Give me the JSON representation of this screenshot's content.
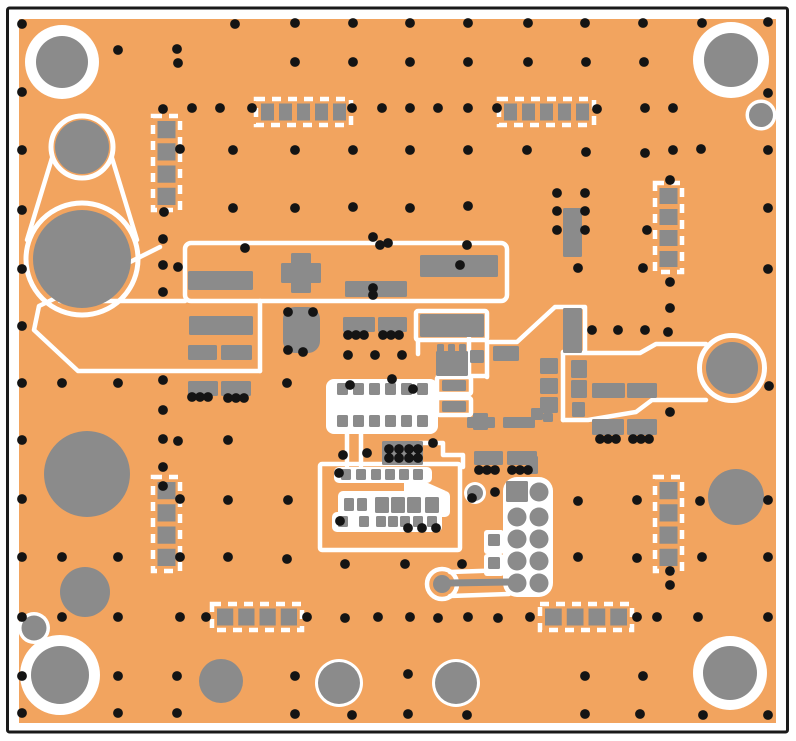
{
  "figure": {
    "kind": "pcb-layout-top-view",
    "width": 796,
    "height": 741
  },
  "colors": {
    "page": "#FFFFFF",
    "frame": "#1A1A1A",
    "board": "#F2A45F",
    "copper": "#8B8B8B",
    "silk": "#FFFFFF",
    "via": "#141414"
  },
  "frame": {
    "x": 7.5,
    "y": 8,
    "w": 780,
    "h": 724,
    "stroke": 3
  },
  "board": {
    "x": 19,
    "y": 19,
    "w": 757,
    "h": 704
  },
  "silk_strokes": [
    {
      "t": "ci",
      "c": [
        82,
        147,
        31
      ],
      "sw": 5
    },
    {
      "t": "ci",
      "c": [
        82,
        259,
        56
      ],
      "sw": 5
    },
    {
      "t": "ln",
      "c": [
        52,
        158,
        27,
        240
      ]
    },
    {
      "t": "ln",
      "c": [
        112,
        158,
        137,
        240
      ]
    },
    {
      "t": "pl",
      "p": "160,247 100,277 39,306 34,330 78,371 260,371"
    },
    {
      "t": "ln",
      "c": [
        60,
        301,
        185,
        301
      ]
    },
    {
      "t": "rc",
      "c": [
        185,
        243,
        322,
        58
      ],
      "rx": 6
    },
    {
      "t": "ln",
      "c": [
        260,
        301,
        260,
        371
      ]
    },
    {
      "t": "rc",
      "c": [
        416,
        311,
        71,
        29
      ]
    },
    {
      "t": "ln",
      "c": [
        469,
        338,
        469,
        377
      ]
    },
    {
      "t": "ln",
      "c": [
        487,
        342,
        487,
        377
      ]
    },
    {
      "t": "ln",
      "c": [
        438,
        376,
        487,
        376
      ]
    },
    {
      "t": "ln",
      "c": [
        418,
        340,
        418,
        354
      ]
    },
    {
      "t": "pl",
      "p": "487,342 517,342 555,307 585,307 585,352"
    },
    {
      "t": "pl",
      "p": "563,353 640,353 656,344 706,344"
    },
    {
      "t": "ln",
      "c": [
        563,
        420,
        563,
        352
      ]
    },
    {
      "t": "pl",
      "p": "706,400 652,400 636,412 588,420 563,420"
    },
    {
      "t": "ci",
      "c": [
        732,
        368,
        32.5
      ],
      "sw": 5
    },
    {
      "t": "ci",
      "c": [
        442,
        584,
        15
      ],
      "sw": 4.5
    },
    {
      "t": "ln",
      "c": [
        450,
        572,
        509,
        570
      ]
    },
    {
      "t": "ln",
      "c": [
        450,
        596,
        509,
        594
      ]
    },
    {
      "t": "rc",
      "c": [
        320,
        464,
        140,
        86
      ]
    },
    {
      "t": "ln",
      "c": [
        347,
        432,
        347,
        466
      ]
    },
    {
      "t": "ln",
      "c": [
        361,
        432,
        361,
        466
      ]
    },
    {
      "t": "pl",
      "p": "420,443 443,443 443,455 463,455 463,467"
    },
    {
      "t": "rc",
      "c": [
        437,
        377,
        34,
        17
      ]
    },
    {
      "t": "rc",
      "c": [
        437,
        398,
        34,
        17
      ]
    }
  ],
  "silk_blobs": [
    {
      "t": "rc",
      "c": [
        326,
        379,
        112,
        55
      ],
      "rx": 8
    },
    {
      "t": "rc",
      "c": [
        334,
        467,
        98,
        16
      ],
      "rx": 5
    },
    {
      "t": "rc",
      "c": [
        338,
        491,
        112,
        26
      ],
      "rx": 5
    },
    {
      "t": "rc",
      "c": [
        332,
        512,
        110,
        20
      ],
      "rx": 5
    },
    {
      "t": "pg",
      "p": "404,483 428,483 446,491 404,491"
    },
    {
      "t": "rc",
      "c": [
        503,
        477,
        50,
        120
      ],
      "rx": 14
    },
    {
      "t": "rc",
      "c": [
        484,
        530,
        20,
        24
      ],
      "rx": 3
    },
    {
      "t": "rc",
      "c": [
        484,
        554,
        20,
        22
      ],
      "rx": 3
    }
  ],
  "footprints": [
    {
      "x": 153,
      "y": 116,
      "w": 27,
      "h": 94,
      "n": 4,
      "dir": "v"
    },
    {
      "x": 153,
      "y": 477,
      "w": 27,
      "h": 94,
      "n": 4,
      "dir": "v"
    },
    {
      "x": 655,
      "y": 183,
      "w": 27,
      "h": 89,
      "n": 4,
      "dir": "v"
    },
    {
      "x": 655,
      "y": 477,
      "w": 27,
      "h": 94,
      "n": 4,
      "dir": "v"
    },
    {
      "x": 256,
      "y": 99,
      "w": 95,
      "h": 26,
      "n": 5,
      "dir": "h"
    },
    {
      "x": 499,
      "y": 99,
      "w": 95,
      "h": 26,
      "n": 5,
      "dir": "h"
    },
    {
      "x": 212,
      "y": 604,
      "w": 90,
      "h": 26,
      "n": 4,
      "dir": "h"
    },
    {
      "x": 540,
      "y": 604,
      "w": 92,
      "h": 26,
      "n": 4,
      "dir": "h"
    }
  ],
  "pads": [
    [
      188,
      271,
      65,
      19
    ],
    [
      420,
      255,
      78,
      22
    ],
    [
      345,
      281,
      62,
      16
    ],
    [
      281,
      263,
      40,
      20
    ],
    [
      291,
      253,
      20,
      40
    ],
    [
      189,
      316,
      64,
      19
    ],
    [
      188,
      345,
      29,
      15
    ],
    [
      221,
      345,
      31,
      15
    ],
    [
      188,
      381,
      30,
      15
    ],
    [
      221,
      381,
      30,
      15
    ],
    [
      343,
      317,
      32,
      15
    ],
    [
      378,
      317,
      29,
      15
    ],
    [
      283,
      307,
      37,
      46,
      12
    ],
    [
      420,
      314,
      64,
      23
    ],
    [
      436,
      351,
      32,
      25
    ],
    [
      437,
      344,
      7,
      8
    ],
    [
      448,
      344,
      7,
      8
    ],
    [
      459,
      344,
      7,
      8
    ],
    [
      470,
      350,
      14,
      13
    ],
    [
      493,
      346,
      26,
      15
    ],
    [
      563,
      308,
      19,
      45
    ],
    [
      563,
      208,
      19,
      49
    ],
    [
      540,
      358,
      18,
      16
    ],
    [
      540,
      378,
      18,
      16
    ],
    [
      540,
      397,
      18,
      16
    ],
    [
      571,
      360,
      16,
      18
    ],
    [
      571,
      380,
      16,
      18
    ],
    [
      572,
      402,
      13,
      15
    ],
    [
      592,
      383,
      33,
      15
    ],
    [
      627,
      383,
      30,
      15
    ],
    [
      592,
      419,
      32,
      16
    ],
    [
      627,
      419,
      30,
      16
    ],
    [
      531,
      408,
      12,
      12
    ],
    [
      543,
      413,
      10,
      9
    ],
    [
      526,
      456,
      12,
      18
    ],
    [
      467,
      417,
      28,
      11
    ],
    [
      503,
      417,
      32,
      11
    ],
    [
      474,
      451,
      29,
      14
    ],
    [
      507,
      451,
      30,
      14
    ],
    [
      506,
      481,
      22,
      21
    ],
    [
      488,
      534,
      12,
      12
    ],
    [
      488,
      557,
      12,
      12
    ],
    [
      442,
      380,
      24,
      11
    ],
    [
      442,
      401,
      24,
      11
    ],
    [
      473,
      413,
      15,
      17
    ],
    [
      382,
      441,
      41,
      24
    ],
    [
      337,
      383,
      11,
      12
    ],
    [
      353,
      383,
      11,
      12
    ],
    [
      369,
      383,
      11,
      12
    ],
    [
      385,
      383,
      11,
      12
    ],
    [
      401,
      383,
      11,
      12
    ],
    [
      417,
      383,
      11,
      12
    ],
    [
      337,
      415,
      11,
      12
    ],
    [
      353,
      415,
      11,
      12
    ],
    [
      369,
      415,
      11,
      12
    ],
    [
      385,
      415,
      11,
      12
    ],
    [
      401,
      415,
      11,
      12
    ],
    [
      417,
      415,
      11,
      12
    ],
    [
      341,
      469,
      10,
      11
    ],
    [
      356,
      469,
      10,
      11
    ],
    [
      371,
      469,
      10,
      11
    ],
    [
      385,
      469,
      10,
      11
    ],
    [
      399,
      469,
      10,
      11
    ],
    [
      413,
      469,
      10,
      11
    ],
    [
      344,
      498,
      10,
      13
    ],
    [
      357,
      498,
      10,
      13
    ],
    [
      375,
      497,
      14,
      16
    ],
    [
      391,
      497,
      14,
      16
    ],
    [
      407,
      497,
      14,
      16
    ],
    [
      425,
      497,
      14,
      16
    ],
    [
      338,
      516,
      10,
      11
    ],
    [
      359,
      516,
      10,
      11
    ],
    [
      376,
      516,
      10,
      11
    ],
    [
      388,
      516,
      10,
      11
    ],
    [
      400,
      516,
      10,
      11
    ],
    [
      413,
      516,
      10,
      11
    ],
    [
      427,
      516,
      10,
      11
    ]
  ],
  "copper_trace": {
    "x1": 450,
    "y1": 583,
    "x2": 512,
    "y2": 582,
    "w": 7
  },
  "plain_circles": [
    [
      82,
      147,
      27
    ],
    [
      82,
      259,
      49
    ],
    [
      87,
      474,
      43
    ],
    [
      85,
      592,
      25
    ],
    [
      221,
      681,
      22
    ],
    [
      736,
      497,
      28
    ],
    [
      732,
      368,
      26
    ],
    [
      442,
      584,
      9
    ],
    [
      539,
      492,
      9.5
    ],
    [
      517,
      517,
      9.5
    ],
    [
      539,
      517,
      9.5
    ],
    [
      517,
      539,
      9.5
    ],
    [
      539,
      539,
      9.5
    ],
    [
      517,
      561,
      9.5
    ],
    [
      539,
      561,
      9.5
    ],
    [
      517,
      583,
      9.5
    ],
    [
      539,
      583,
      9.5
    ]
  ],
  "ringed_circles": [
    {
      "name": "mounting-hole",
      "c": [
        62,
        62,
        26,
        37
      ]
    },
    {
      "name": "mounting-hole",
      "c": [
        731,
        60,
        27,
        38
      ]
    },
    {
      "name": "mounting-hole",
      "c": [
        60,
        675,
        29,
        40
      ]
    },
    {
      "name": "mounting-hole",
      "c": [
        730,
        673,
        27,
        37
      ]
    },
    {
      "name": "plated-hole",
      "c": [
        761,
        115,
        12,
        15.5
      ]
    },
    {
      "name": "plated-hole",
      "c": [
        34,
        628,
        12.5,
        16
      ]
    },
    {
      "name": "plated-hole",
      "c": [
        339,
        683,
        21,
        24
      ]
    },
    {
      "name": "plated-hole",
      "c": [
        456,
        683,
        21,
        24
      ]
    },
    {
      "name": "plated-hole",
      "c": [
        475,
        493,
        8,
        11
      ]
    }
  ],
  "via_radius": 4.9,
  "vias": [
    [
      22,
      24
    ],
    [
      235,
      24
    ],
    [
      295,
      23
    ],
    [
      353,
      23
    ],
    [
      410,
      23
    ],
    [
      468,
      23
    ],
    [
      528,
      23
    ],
    [
      585,
      23
    ],
    [
      643,
      23
    ],
    [
      702,
      23
    ],
    [
      768,
      22
    ],
    [
      118,
      50
    ],
    [
      177,
      49
    ],
    [
      178,
      63
    ],
    [
      295,
      62
    ],
    [
      353,
      62
    ],
    [
      410,
      62
    ],
    [
      468,
      62
    ],
    [
      528,
      62
    ],
    [
      586,
      62
    ],
    [
      644,
      62
    ],
    [
      22,
      92
    ],
    [
      768,
      93
    ],
    [
      163,
      109
    ],
    [
      192,
      108
    ],
    [
      220,
      108
    ],
    [
      252,
      108
    ],
    [
      352,
      108
    ],
    [
      382,
      108
    ],
    [
      410,
      108
    ],
    [
      438,
      108
    ],
    [
      468,
      108
    ],
    [
      497,
      108
    ],
    [
      597,
      109
    ],
    [
      645,
      108
    ],
    [
      673,
      108
    ],
    [
      22,
      150
    ],
    [
      180,
      149
    ],
    [
      233,
      150
    ],
    [
      295,
      150
    ],
    [
      353,
      150
    ],
    [
      410,
      150
    ],
    [
      468,
      150
    ],
    [
      527,
      150
    ],
    [
      586,
      152
    ],
    [
      645,
      153
    ],
    [
      673,
      150
    ],
    [
      701,
      149
    ],
    [
      768,
      150
    ],
    [
      557,
      193
    ],
    [
      585,
      193
    ],
    [
      670,
      180
    ],
    [
      22,
      210
    ],
    [
      164,
      212
    ],
    [
      233,
      208
    ],
    [
      295,
      208
    ],
    [
      353,
      207
    ],
    [
      410,
      208
    ],
    [
      468,
      206
    ],
    [
      557,
      211
    ],
    [
      585,
      211
    ],
    [
      768,
      208
    ],
    [
      557,
      230
    ],
    [
      585,
      230
    ],
    [
      647,
      230
    ],
    [
      163,
      239
    ],
    [
      245,
      248
    ],
    [
      373,
      237
    ],
    [
      380,
      245
    ],
    [
      388,
      243
    ],
    [
      467,
      245
    ],
    [
      22,
      269
    ],
    [
      163,
      265
    ],
    [
      178,
      267
    ],
    [
      460,
      265
    ],
    [
      768,
      269
    ],
    [
      578,
      268
    ],
    [
      643,
      268
    ],
    [
      670,
      282
    ],
    [
      670,
      308
    ],
    [
      163,
      292
    ],
    [
      373,
      288
    ],
    [
      373,
      295
    ],
    [
      288,
      312
    ],
    [
      313,
      312
    ],
    [
      22,
      326
    ],
    [
      592,
      330
    ],
    [
      618,
      330
    ],
    [
      645,
      330
    ],
    [
      668,
      332
    ],
    [
      348,
      335
    ],
    [
      356,
      335
    ],
    [
      364,
      335
    ],
    [
      383,
      335
    ],
    [
      391,
      335
    ],
    [
      399,
      335
    ],
    [
      288,
      350
    ],
    [
      303,
      352
    ],
    [
      348,
      355
    ],
    [
      375,
      355
    ],
    [
      402,
      355
    ],
    [
      22,
      383
    ],
    [
      62,
      383
    ],
    [
      118,
      383
    ],
    [
      163,
      380
    ],
    [
      287,
      383
    ],
    [
      350,
      385
    ],
    [
      769,
      386
    ],
    [
      192,
      397
    ],
    [
      200,
      397
    ],
    [
      208,
      397
    ],
    [
      228,
      398
    ],
    [
      236,
      398
    ],
    [
      244,
      398
    ],
    [
      163,
      410
    ],
    [
      670,
      412
    ],
    [
      22,
      440
    ],
    [
      163,
      439
    ],
    [
      178,
      441
    ],
    [
      228,
      440
    ],
    [
      433,
      443
    ],
    [
      600,
      439
    ],
    [
      608,
      439
    ],
    [
      616,
      439
    ],
    [
      633,
      439
    ],
    [
      641,
      439
    ],
    [
      649,
      439
    ],
    [
      389,
      449
    ],
    [
      399,
      449
    ],
    [
      409,
      449
    ],
    [
      418,
      449
    ],
    [
      389,
      458
    ],
    [
      399,
      458
    ],
    [
      409,
      458
    ],
    [
      418,
      458
    ],
    [
      343,
      455
    ],
    [
      367,
      453
    ],
    [
      479,
      470
    ],
    [
      487,
      470
    ],
    [
      495,
      470
    ],
    [
      512,
      470
    ],
    [
      520,
      470
    ],
    [
      528,
      470
    ],
    [
      163,
      467
    ],
    [
      339,
      473
    ],
    [
      163,
      486
    ],
    [
      495,
      492
    ],
    [
      392,
      379
    ],
    [
      413,
      389
    ],
    [
      340,
      521
    ],
    [
      408,
      528
    ],
    [
      422,
      528
    ],
    [
      436,
      528
    ],
    [
      22,
      499
    ],
    [
      180,
      499
    ],
    [
      228,
      500
    ],
    [
      288,
      500
    ],
    [
      472,
      498
    ],
    [
      578,
      501
    ],
    [
      637,
      500
    ],
    [
      700,
      501
    ],
    [
      768,
      500
    ],
    [
      22,
      557
    ],
    [
      62,
      557
    ],
    [
      118,
      557
    ],
    [
      180,
      557
    ],
    [
      228,
      557
    ],
    [
      287,
      559
    ],
    [
      345,
      564
    ],
    [
      405,
      564
    ],
    [
      462,
      564
    ],
    [
      578,
      557
    ],
    [
      637,
      558
    ],
    [
      702,
      557
    ],
    [
      768,
      557
    ],
    [
      670,
      571
    ],
    [
      670,
      585
    ],
    [
      22,
      617
    ],
    [
      62,
      617
    ],
    [
      118,
      617
    ],
    [
      180,
      617
    ],
    [
      206,
      617
    ],
    [
      307,
      617
    ],
    [
      345,
      618
    ],
    [
      378,
      617
    ],
    [
      410,
      617
    ],
    [
      438,
      618
    ],
    [
      468,
      617
    ],
    [
      498,
      618
    ],
    [
      530,
      617
    ],
    [
      637,
      617
    ],
    [
      657,
      617
    ],
    [
      698,
      617
    ],
    [
      768,
      617
    ],
    [
      22,
      676
    ],
    [
      118,
      676
    ],
    [
      177,
      676
    ],
    [
      295,
      676
    ],
    [
      408,
      674
    ],
    [
      585,
      676
    ],
    [
      643,
      676
    ],
    [
      22,
      713
    ],
    [
      118,
      713
    ],
    [
      177,
      713
    ],
    [
      295,
      714
    ],
    [
      352,
      715
    ],
    [
      408,
      714
    ],
    [
      467,
      715
    ],
    [
      585,
      714
    ],
    [
      640,
      714
    ],
    [
      703,
      715
    ],
    [
      768,
      715
    ]
  ]
}
